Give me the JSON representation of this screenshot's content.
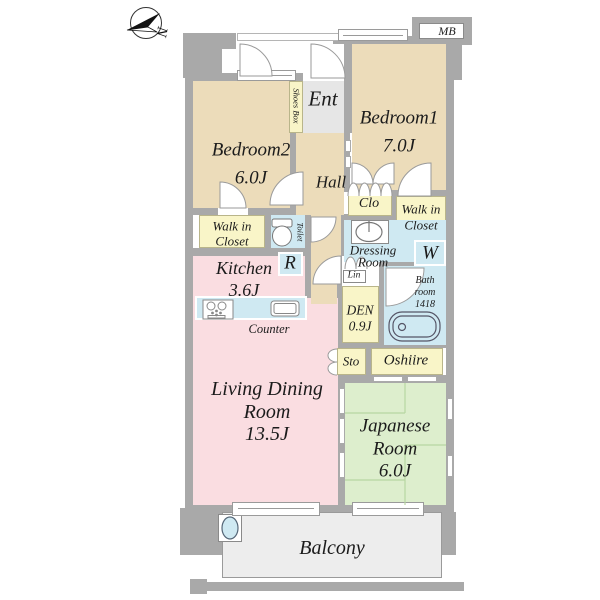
{
  "colors": {
    "wall": "#a9a9a9",
    "bedroom": "#ecdcba",
    "living": "#fadde1",
    "closet": "#f9f5c8",
    "wet_area": "#cfe9f2",
    "japanese": "#ddeecd",
    "entrance": "#e6e6e6",
    "balcony": "#ededed"
  },
  "compass": {
    "label": "N"
  },
  "rooms": {
    "meter_box": {
      "label": "MB"
    },
    "entrance": {
      "label": "Ent"
    },
    "shoes_box": {
      "label": "Shoes Box"
    },
    "hall": {
      "label": "Hall"
    },
    "bedroom1": {
      "name": "Bedroom1",
      "size": "7.0J"
    },
    "bedroom2": {
      "name": "Bedroom2",
      "size": "6.0J"
    },
    "walk_in_closet_left": {
      "line1": "Walk in",
      "line2": "Closet"
    },
    "walk_in_closet_right": {
      "line1": "Walk in",
      "line2": "Closet"
    },
    "toilet": {
      "label": "Toilet"
    },
    "closet": {
      "label": "Clo"
    },
    "dressing_room": {
      "line1": "Dressing",
      "line2": "Room"
    },
    "washer": {
      "label": "W"
    },
    "linen": {
      "label": "Lin"
    },
    "bathroom": {
      "line1": "Bath",
      "line2": "room",
      "line3": "1418"
    },
    "kitchen": {
      "name": "Kitchen",
      "size": "3.6J"
    },
    "refrigerator": {
      "label": "R"
    },
    "counter": {
      "label": "Counter"
    },
    "den": {
      "name": "DEN",
      "size": "0.9J"
    },
    "storage": {
      "label": "Sto"
    },
    "oshiire": {
      "label": "Oshiire"
    },
    "living_dining": {
      "line1": "Living Dining",
      "line2": "Room",
      "size": "13.5J"
    },
    "japanese_room": {
      "line1": "Japanese",
      "line2": "Room",
      "size": "6.0J"
    },
    "balcony": {
      "label": "Balcony"
    }
  }
}
